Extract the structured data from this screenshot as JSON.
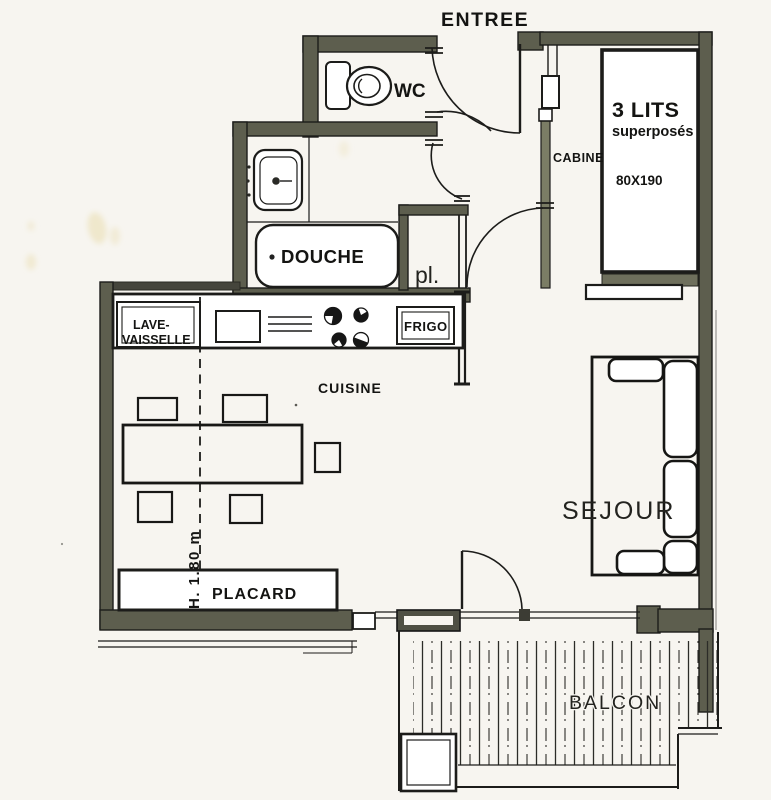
{
  "colors": {
    "paper": "#f7f5f0",
    "wall": "#5d5e4e",
    "partition": "#7b7d65",
    "ink": "#1c1c1a",
    "stain": "#e9dcae"
  },
  "plan": {
    "entree": "ENTREE",
    "wc": "WC",
    "cabine": "CABINE",
    "bed": {
      "line1": "3 LITS",
      "line2": "superposés",
      "dim": "80X190"
    },
    "douche": "DOUCHE",
    "pl": "pl.",
    "kitchen": {
      "lave1": "LAVE-",
      "lave2": "VAISSELLE",
      "frigo": "FRIGO",
      "cuisine": "CUISINE"
    },
    "sejour": "SEJOUR",
    "placard": "PLACARD",
    "height_note": "H. 1.80 m",
    "balcon": "BALCON"
  }
}
